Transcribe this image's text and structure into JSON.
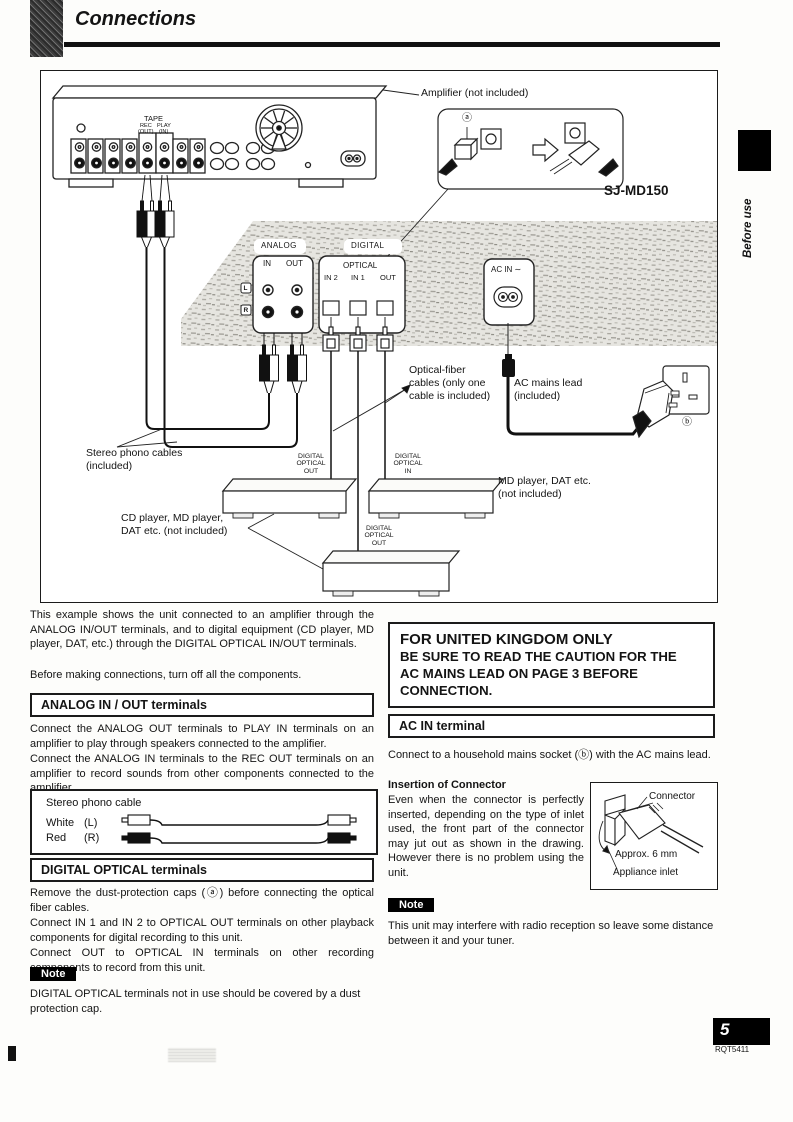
{
  "page": {
    "title": "Connections",
    "side_tab": "Before use",
    "page_number": "5",
    "doc_code": "RQT5411"
  },
  "diagram": {
    "amplifier_label": "Amplifier (not included)",
    "model": "SJ-MD150",
    "cap_marker": "ⓐ",
    "socket_marker": "ⓑ",
    "amp": {
      "tape": "TAPE",
      "rec": "REC",
      "rec_sub": "(OUT)",
      "play": "PLAY",
      "play_sub": "(IN)"
    },
    "rear": {
      "analog": "ANALOG",
      "in": "IN",
      "out": "OUT",
      "l": "L",
      "r": "R",
      "digital": "DIGITAL",
      "optical": "OPTICAL",
      "in2": "IN 2",
      "in1": "IN 1",
      "opt_out": "OUT",
      "ac_in": "AC IN ∼"
    },
    "labels": {
      "optical_fiber": "Optical-fiber\ncables (only one\ncable is included)",
      "ac_mains": "AC mains lead\n(included)",
      "stereo_phono": "Stereo phono cables\n(included)",
      "dig_opt_out": "DIGITAL\nOPTICAL\nOUT",
      "dig_opt_in": "DIGITAL\nOPTICAL\nIN",
      "cd_player": "CD player, MD player,\nDAT etc. (not included)",
      "md_player": "MD player, DAT etc.\n(not included)"
    }
  },
  "left": {
    "intro": "This example shows the unit connected to an amplifier through the ANALOG IN/OUT terminals, and to digital equipment (CD player, MD player, DAT, etc.) through the DIGITAL OPTICAL IN/OUT terminals.",
    "intro2": "Before making connections, turn off all the components.",
    "analog_header": "ANALOG IN / OUT terminals",
    "analog_p1": "Connect the ANALOG OUT terminals to PLAY IN terminals on an amplifier to play through speakers connected to the amplifier.",
    "analog_p2": "Connect the ANALOG IN terminals to the REC OUT terminals on an amplifier to record sounds from other components connected to the amplifier.",
    "phono_box": {
      "title": "Stereo phono cable",
      "white": "White",
      "white_ch": "(L)",
      "red": "Red",
      "red_ch": "(R)"
    },
    "digital_header": "DIGITAL OPTICAL terminals",
    "digital_p1": "Remove the dust-protection caps (ⓐ) before connecting the optical fiber cables.",
    "digital_p2": "Connect IN 1 and IN 2 to OPTICAL OUT terminals on other playback components for digital recording to this unit.",
    "digital_p3": "Connect OUT to OPTICAL IN terminals on other recording components to record from this unit.",
    "note_label": "Note",
    "note_text": "DIGITAL OPTICAL terminals not in use should be covered by a dust protection cap."
  },
  "right": {
    "uk_title": "FOR UNITED KINGDOM ONLY",
    "uk_body": "BE SURE TO READ THE CAUTION FOR THE\nAC MAINS LEAD ON PAGE 3 BEFORE\nCONNECTION.",
    "ac_header": "AC IN terminal",
    "ac_text": "Connect to a household mains socket (ⓑ) with the AC mains lead.",
    "insertion_title": "Insertion of Connector",
    "insertion_text": "Even when the connector is perfectly inserted, depending on the type of inlet used, the front part of the connector may jut out as shown in the drawing. However there is no problem using the unit.",
    "fig": {
      "connector": "Connector",
      "approx": "Approx. 6 mm",
      "inlet": "Appliance inlet"
    },
    "note_label": "Note",
    "note_text": "This unit may interfere with radio reception so leave some distance between it and your tuner."
  }
}
